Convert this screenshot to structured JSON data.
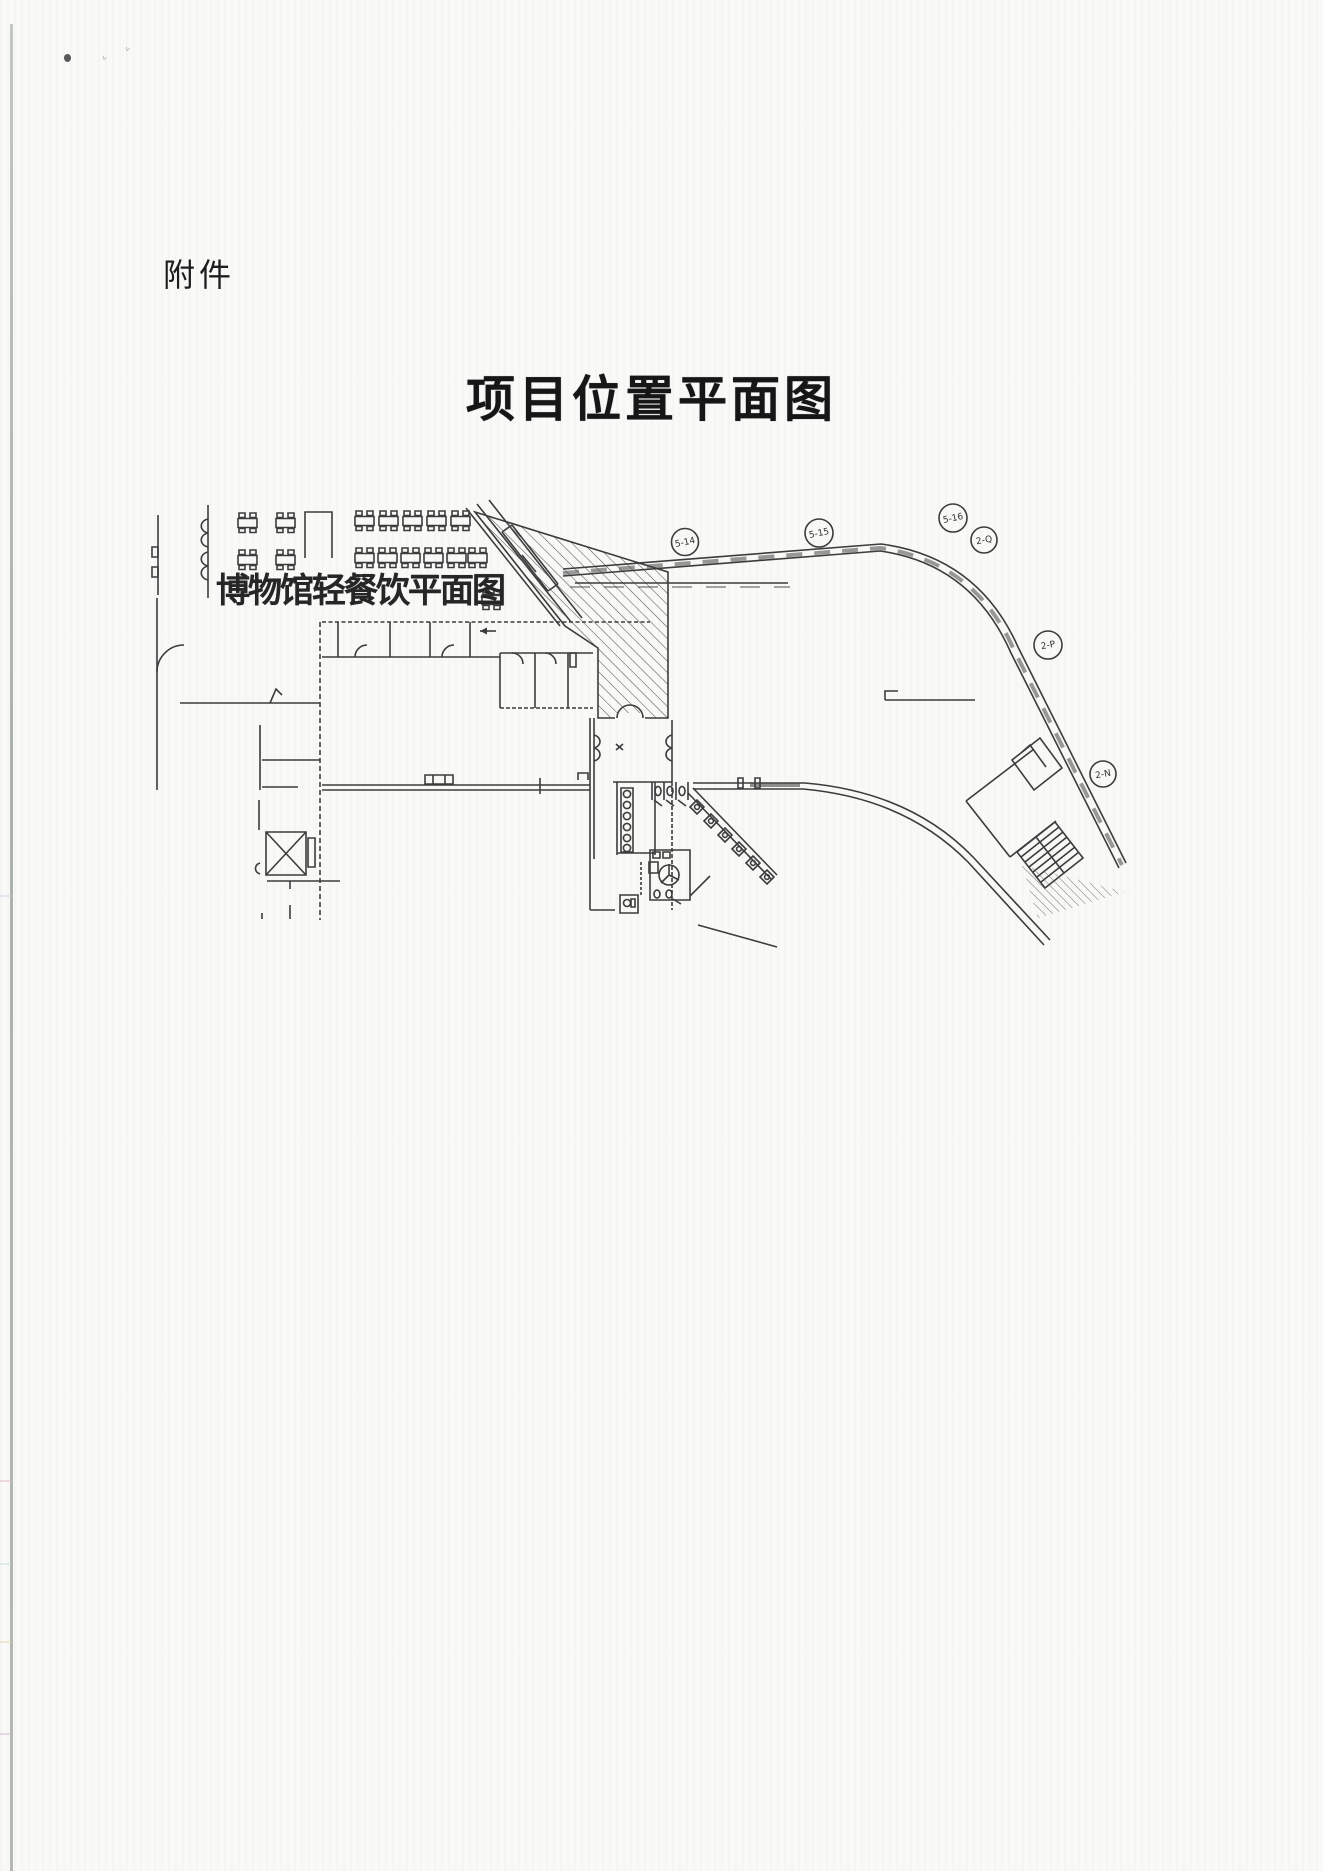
{
  "page": {
    "attachment_label": "附件",
    "title": "项目位置平面图"
  },
  "plan": {
    "label": "博物馆轻餐饮平面图",
    "bubbles": [
      {
        "label": "5-14"
      },
      {
        "label": "5-15"
      },
      {
        "label": "5-16"
      },
      {
        "label": "2-Q"
      },
      {
        "label": "2-P"
      },
      {
        "label": "2-N"
      }
    ]
  },
  "colors": {
    "ink": "#3c3c3c",
    "paper": "#f9f9f7",
    "scan_edge": "#a4aaa4"
  }
}
